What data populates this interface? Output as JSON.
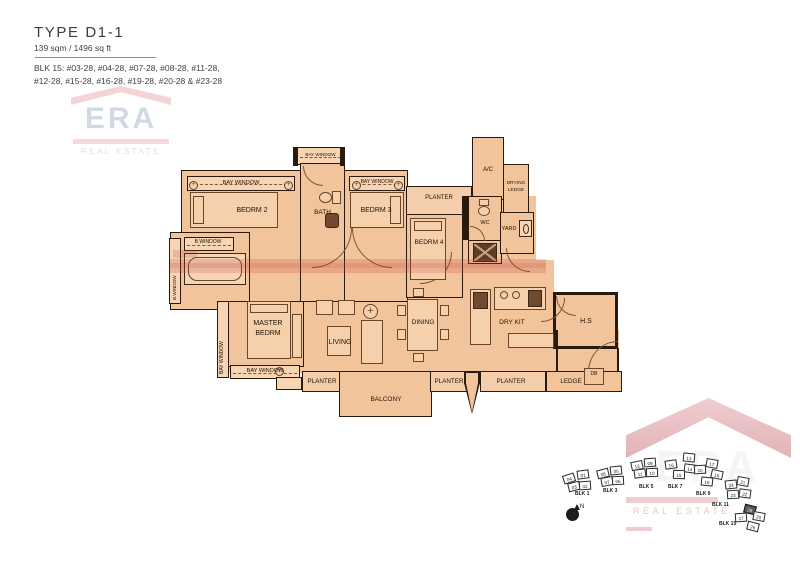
{
  "header": {
    "type_title": "TYPE D1-1",
    "area": "139 sqm / 1496 sq ft",
    "blk_line1": "BLK 15:  #03-28, #04-28, #07-28, #08-28, #11-28,",
    "blk_line2": "#12-28, #15-28, #16-28, #19-28, #20-28 & #23-28"
  },
  "watermark": {
    "era": "ERA",
    "real_estate": "REAL ESTATE"
  },
  "plan": {
    "labels": {
      "bay_window": "BAY WINDOW",
      "b_window": "B.WINDOW",
      "bedrm2": "BEDRM 2",
      "bath": "BATH",
      "bedrm3": "BEDRM 3",
      "planter": "PLANTER",
      "ac": "A/C",
      "drying": "DRYING",
      "ledge_word": "LEDGE",
      "wc": "WC",
      "yard": "YARD",
      "bedrm4": "BEDRM 4",
      "master1": "MASTER",
      "master2": "BEDRM",
      "living": "LIVING",
      "dining": "DINING",
      "dry_kit": "DRY KIT",
      "hs": "H.S",
      "balcony": "BALCONY",
      "ledge": "LEDGE",
      "db": "DB"
    }
  },
  "site_plan": {
    "north_label": "N",
    "blocks": [
      {
        "label": "BLK 1",
        "lx": 575,
        "ly": 491,
        "units": [
          {
            "no": "04",
            "x": 563,
            "y": 474,
            "r": -18
          },
          {
            "no": "01",
            "x": 577,
            "y": 470,
            "r": -8
          },
          {
            "no": "03",
            "x": 568,
            "y": 482,
            "r": -14
          },
          {
            "no": "02",
            "x": 579,
            "y": 481,
            "r": -4
          }
        ]
      },
      {
        "label": "BLK 3",
        "lx": 603,
        "ly": 488,
        "units": [
          {
            "no": "08",
            "x": 597,
            "y": 469,
            "r": -14
          },
          {
            "no": "05",
            "x": 610,
            "y": 466,
            "r": -6
          },
          {
            "no": "07",
            "x": 601,
            "y": 477,
            "r": -10
          },
          {
            "no": "06",
            "x": 612,
            "y": 476,
            "r": -3
          }
        ]
      },
      {
        "label": "BLK 5",
        "lx": 639,
        "ly": 484,
        "units": [
          {
            "no": "12",
            "x": 631,
            "y": 461,
            "r": -12
          },
          {
            "no": "09",
            "x": 644,
            "y": 458,
            "r": -4
          },
          {
            "no": "11",
            "x": 634,
            "y": 469,
            "r": -8
          },
          {
            "no": "10",
            "x": 646,
            "y": 468,
            "r": -2
          }
        ]
      },
      {
        "label": "BLK 7",
        "lx": 668,
        "ly": 484,
        "units": [
          {
            "no": "13",
            "x": 683,
            "y": 453,
            "r": 6
          },
          {
            "no": "16",
            "x": 665,
            "y": 460,
            "r": -8
          },
          {
            "no": "14",
            "x": 684,
            "y": 464,
            "r": 8
          },
          {
            "no": "15",
            "x": 673,
            "y": 470,
            "r": 2
          }
        ]
      },
      {
        "label": "BLK 9",
        "lx": 696,
        "ly": 491,
        "units": [
          {
            "no": "17",
            "x": 706,
            "y": 459,
            "r": 10
          },
          {
            "no": "20",
            "x": 694,
            "y": 465,
            "r": -4
          },
          {
            "no": "18",
            "x": 711,
            "y": 470,
            "r": 12
          },
          {
            "no": "19",
            "x": 701,
            "y": 477,
            "r": 6
          }
        ]
      },
      {
        "label": "BLK 11",
        "lx": 712,
        "ly": 502,
        "units": [
          {
            "no": "24",
            "x": 725,
            "y": 480,
            "r": -6
          },
          {
            "no": "21",
            "x": 737,
            "y": 477,
            "r": 10
          },
          {
            "no": "23",
            "x": 727,
            "y": 490,
            "r": -3
          },
          {
            "no": "22",
            "x": 739,
            "y": 489,
            "r": 8
          }
        ]
      },
      {
        "label": "BLK 15",
        "lx": 719,
        "ly": 521,
        "units": [
          {
            "no": "28",
            "x": 744,
            "y": 505,
            "r": 14,
            "hl": true
          },
          {
            "no": "27",
            "x": 735,
            "y": 513,
            "r": -4
          },
          {
            "no": "25",
            "x": 753,
            "y": 512,
            "r": 10
          },
          {
            "no": "26",
            "x": 747,
            "y": 522,
            "r": 14
          }
        ]
      }
    ]
  },
  "colors": {
    "plan_fill": "#f2c49c",
    "wall": "#291a0d",
    "watermark_red": "#d98e93",
    "watermark_navy": "#b7c1d3",
    "highlight_unit": "#5a5a5a"
  }
}
